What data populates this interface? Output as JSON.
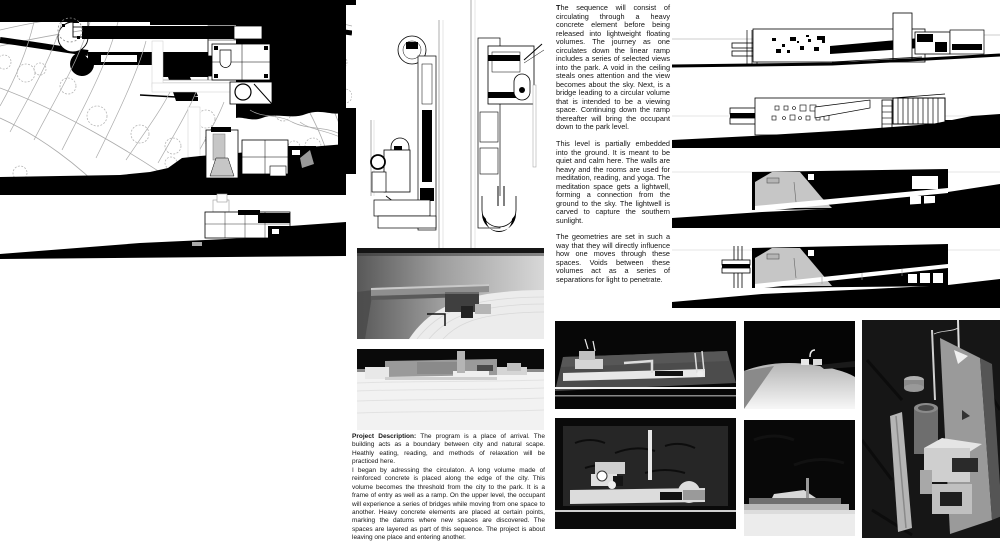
{
  "colors": {
    "paper": "#ffffff",
    "ink": "#000000",
    "mound_gray": "#c6c6c6",
    "photo_background": "#070707",
    "model_gray": "#9a9a9a"
  },
  "sequence_text": {
    "paragraphs": [
      "The sequence will consist of circulating through a heavy concrete element before being released into lightweight floating volumes. The journey as one circulates down the linear ramp includes a series of selected views into the park. A void in the ceiling steals ones attention and the view becomes about the sky. Next, is a bridge leading to a circular volume that is intended to be a viewing space. Continuing down the ramp thereafter will bring the occupant down to the park level.",
      "This level is partially embedded into the ground. It is meant to be quiet and calm here. The walls are heavy and the rooms are used for meditation, reading, and yoga. The meditation space gets a lightwell, forming a connection from the ground to the sky. The lightwell is carved to capture the southern sunlight.",
      "The geometries are set in such a way that they will directly influence how one moves through these spaces. Voids between these volumes act as a series of separations for light to penetrate."
    ]
  },
  "project_description": {
    "label": "Project Description:",
    "intro": "The program is a place of arrival. The building acts as a boundary between city and natural scape. Heathly eating, reading, and methods of relaxation will be practiced here.",
    "body": "I began by adressing the circulaton. A long volume made of reinforced concrete is placed along the edge of the city. This volume becomes the threshold from the city to the park. It is a frame of entry as well as a ramp. On the upper level, the occupant will experience a series of bridges while moving from one space to another. Heavy concrete elements are placed at certain points, marking the datums where new spaces are discovered. The spaces are layered as part of this sequence. The project is about leaving one place and entering another."
  }
}
